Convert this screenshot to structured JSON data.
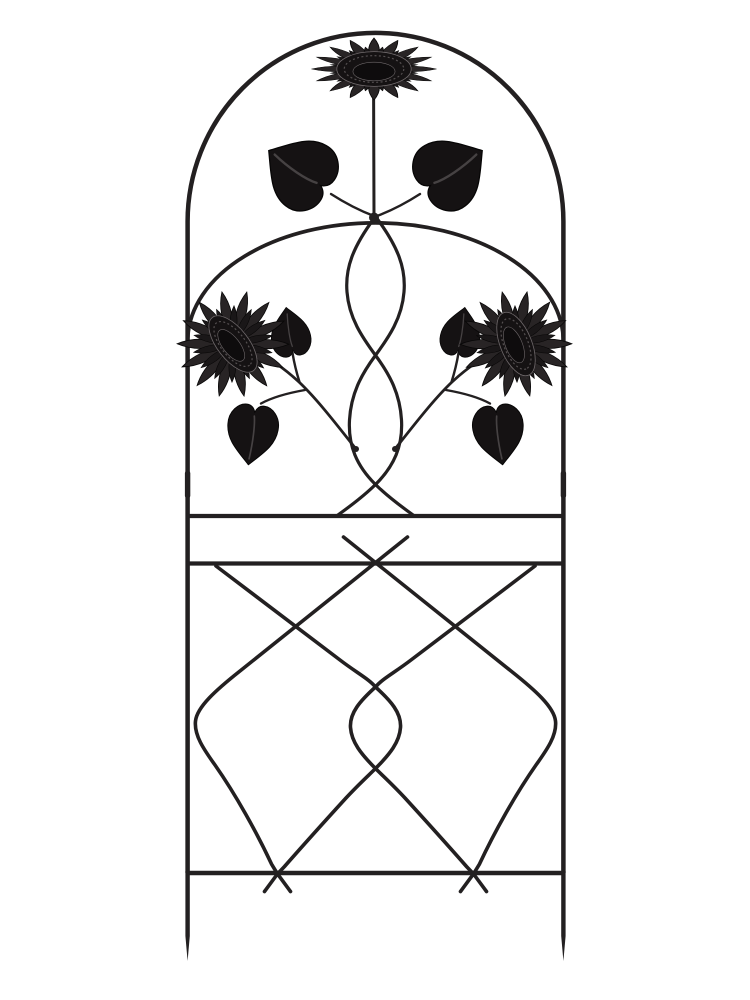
{
  "product": {
    "description": "Black wrought-metal garden trellis with an arched top, a large sunflower medallion at the crown, two scrolled heart leaves, an inner dome with twin sunflower sprays, a double-twist center braid, and a diamond lattice lower panel on pointed ground stakes."
  },
  "colors": {
    "background": "#ffffff",
    "metal": "#232021",
    "metal-dark": "#151213",
    "metal-mid": "#282425",
    "petal-inner": "#1a1718",
    "disk": "#0e0c0d",
    "highlight": "#6f696b"
  },
  "parts": [
    "arched outer frame",
    "side rails",
    "sleeve joints",
    "upper crossbar",
    "middle crossbar",
    "bottom bar",
    "ground stakes",
    "crown sunflower",
    "heart leaves",
    "inner dome arc",
    "center braid",
    "sunflower sprays",
    "lattice wires",
    "stake feet"
  ],
  "flowers": [
    {
      "name": "top-sunflower",
      "x": 374,
      "y": 69,
      "r": 62,
      "squash": 0.5,
      "rot": 0,
      "disk_rot": 0,
      "outer": 16,
      "inner": 16
    },
    {
      "name": "left-sunflower",
      "x": 233,
      "y": 344,
      "r": 56,
      "squash": 0.95,
      "rot": -12,
      "disk_rot": 64,
      "outer": 14,
      "inner": 14
    },
    {
      "name": "right-sunflower",
      "x": 516,
      "y": 344,
      "r": 56,
      "squash": 0.95,
      "rot": 12,
      "disk_rot": 56,
      "outer": 14,
      "inner": 14
    }
  ]
}
